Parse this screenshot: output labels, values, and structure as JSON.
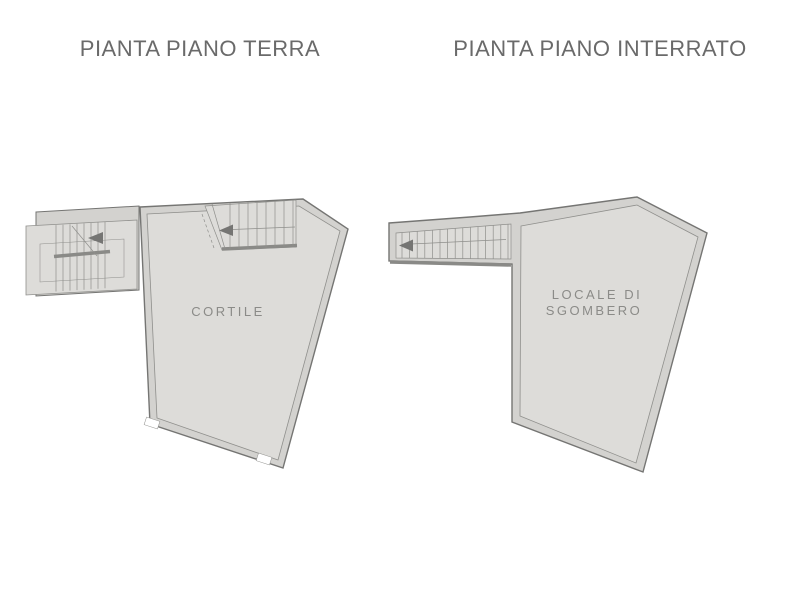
{
  "colors": {
    "page_background": "#ffffff",
    "title_text": "#6a6a6a",
    "wall_fill": "#d3d2cf",
    "floor_fill": "#dddcd9",
    "outline": "#757573",
    "line_light": "#8f8f8c",
    "stair_bar": "#8a8a87",
    "room_label_text": "#8b8b88"
  },
  "plans": [
    {
      "title": "PIANTA PIANO TERRA",
      "room_label": "CORTILE"
    },
    {
      "title": "PIANTA PIANO INTERRATO",
      "room_label_line1": "LOCALE DI",
      "room_label_line2": "SGOMBERO"
    }
  ]
}
